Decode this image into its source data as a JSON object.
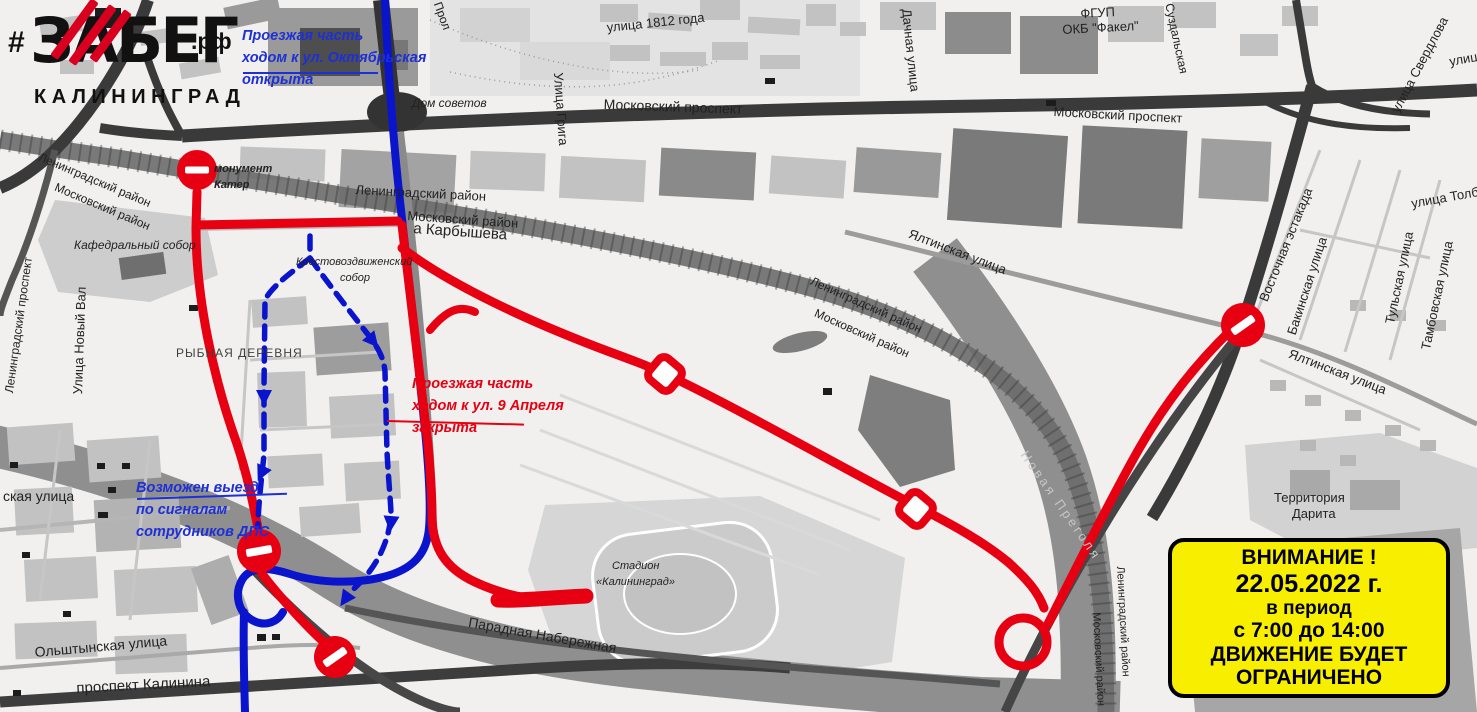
{
  "logo": {
    "hashtag": "#",
    "title": "ЗАБЕГ",
    "tld": ".рф",
    "city": "КАЛИНИНГРАД"
  },
  "annotations": {
    "october_open": {
      "lines": [
        "Проезжая часть",
        "ходом к ул. Октябрьская",
        "открыта"
      ]
    },
    "april_closed": {
      "lines": [
        "Проезжая часть",
        "ходом к ул. 9 Апреля",
        "закрыта"
      ]
    },
    "dps_exit": {
      "lines": [
        "Возможен выезд",
        "по сигналам",
        "сотрудников ДПС"
      ]
    }
  },
  "warning_box": {
    "lines": [
      "ВНИМАНИЕ !",
      "22.05.2022 г.",
      "в период",
      "с 7:00 до 14:00",
      "ДВИЖЕНИЕ БУДЕТ",
      "ОГРАНИЧЕНО"
    ]
  },
  "colors": {
    "route_closed": "#e60012",
    "route_open": "#0a14cc",
    "ann_open": "#1d2fd6",
    "ann_closed": "#e60012",
    "water": "#8f8f8f",
    "road_dark": "#3a3a3a",
    "warning_bg": "#f8ee00",
    "warning_border": "#000000",
    "logo_red": "#d8001e"
  },
  "map": {
    "labels": [
      {
        "t": "Прол",
        "x": 444,
        "y": 0,
        "r": 70,
        "s": 12
      },
      {
        "t": "Дом советов",
        "x": 412,
        "y": 96,
        "s": 12,
        "i": 1
      },
      {
        "t": "улица 1812 года",
        "x": 606,
        "y": 20,
        "r": -6,
        "s": 13
      },
      {
        "t": "Улица Грига",
        "x": 566,
        "y": 72,
        "r": 86,
        "s": 13
      },
      {
        "t": "Московский проспект",
        "x": 604,
        "y": 96,
        "r": 2,
        "s": 14
      },
      {
        "t": "Московский проспект",
        "x": 1054,
        "y": 104,
        "r": 3,
        "s": 13
      },
      {
        "t": "ФГУП",
        "x": 1080,
        "y": 6,
        "r": -3,
        "s": 13
      },
      {
        "t": "ОКБ \"Факел\"",
        "x": 1062,
        "y": 22,
        "r": -3,
        "s": 13
      },
      {
        "t": "Дачная улица",
        "x": 914,
        "y": 8,
        "r": 84,
        "s": 13
      },
      {
        "t": "Суздальская",
        "x": 1176,
        "y": 2,
        "r": 78,
        "s": 12
      },
      {
        "t": "улица Свердлова",
        "x": 1388,
        "y": 108,
        "r": -62,
        "s": 13
      },
      {
        "t": "улица",
        "x": 1448,
        "y": 54,
        "r": -10,
        "s": 13
      },
      {
        "t": "улица Толбухина",
        "x": 1410,
        "y": 196,
        "r": -10,
        "s": 13
      },
      {
        "t": "Тульская улица",
        "x": 1382,
        "y": 322,
        "r": -78,
        "s": 13
      },
      {
        "t": "Тамбовская улица",
        "x": 1418,
        "y": 348,
        "r": -78,
        "s": 13
      },
      {
        "t": "Бакинская улица",
        "x": 1284,
        "y": 332,
        "r": -72,
        "s": 13
      },
      {
        "t": "Восточная эстакада",
        "x": 1256,
        "y": 298,
        "r": -68,
        "s": 13
      },
      {
        "t": "Ялтинская улица",
        "x": 1292,
        "y": 346,
        "r": 21,
        "s": 13
      },
      {
        "t": "Ялтинская улица",
        "x": 912,
        "y": 226,
        "r": 21,
        "s": 13
      },
      {
        "t": "Ленинградский проспект",
        "x": 2,
        "y": 392,
        "r": -82,
        "s": 12
      },
      {
        "t": "Ленинградский район",
        "x": 42,
        "y": 150,
        "r": 23,
        "s": 12
      },
      {
        "t": "Московский район",
        "x": 58,
        "y": 180,
        "r": 23,
        "s": 12
      },
      {
        "t": "Кафедральный собор",
        "x": 74,
        "y": 238,
        "s": 12,
        "i": 1
      },
      {
        "t": "монумент",
        "x": 214,
        "y": 163,
        "s": 11,
        "i": 1,
        "b": 1
      },
      {
        "t": "Катер",
        "x": 214,
        "y": 179,
        "s": 11,
        "i": 1,
        "b": 1
      },
      {
        "t": "РЫБНАЯ ДЕРЕВНЯ",
        "x": 176,
        "y": 346,
        "s": 12,
        "ls": 1,
        "c": "#3f3f3f"
      },
      {
        "t": "Улица Новый Вал",
        "x": 70,
        "y": 394,
        "r": -88,
        "s": 13
      },
      {
        "t": "Крестовоздвиженский",
        "x": 296,
        "y": 256,
        "s": 11,
        "i": 1
      },
      {
        "t": "собор",
        "x": 340,
        "y": 272,
        "s": 11,
        "i": 1
      },
      {
        "t": "Ленинградский район",
        "x": 356,
        "y": 182,
        "r": 3,
        "s": 13
      },
      {
        "t": "Московский район",
        "x": 408,
        "y": 208,
        "r": 4,
        "s": 13
      },
      {
        "t": "а Карбышева",
        "x": 414,
        "y": 220,
        "r": 4,
        "s": 15
      },
      {
        "t": "Ленинградский район",
        "x": 814,
        "y": 274,
        "r": 24,
        "s": 12
      },
      {
        "t": "Московский район",
        "x": 818,
        "y": 306,
        "r": 24,
        "s": 12
      },
      {
        "t": "Новая Преголя",
        "x": 1030,
        "y": 448,
        "r": 55,
        "s": 13,
        "c": "#c6c6c6",
        "ls": 3
      },
      {
        "t": "Ленинградский район",
        "x": 1126,
        "y": 566,
        "r": 87,
        "s": 11
      },
      {
        "t": "Московский район",
        "x": 1102,
        "y": 612,
        "r": 87,
        "s": 11
      },
      {
        "t": "Территория",
        "x": 1274,
        "y": 490,
        "s": 13
      },
      {
        "t": "Дарита",
        "x": 1292,
        "y": 506,
        "s": 13
      },
      {
        "t": "Стадион",
        "x": 612,
        "y": 560,
        "s": 11,
        "i": 1
      },
      {
        "t": "«Калининград»",
        "x": 596,
        "y": 576,
        "s": 11,
        "i": 1
      },
      {
        "t": "Парадная Набережная",
        "x": 470,
        "y": 614,
        "r": 10,
        "s": 14
      },
      {
        "t": "Ольштынская улица",
        "x": 34,
        "y": 644,
        "r": -5,
        "s": 14
      },
      {
        "t": "проспект Калинина",
        "x": 76,
        "y": 680,
        "r": -3,
        "s": 15
      },
      {
        "t": "ская улица",
        "x": 3,
        "y": 488,
        "s": 14
      }
    ]
  }
}
